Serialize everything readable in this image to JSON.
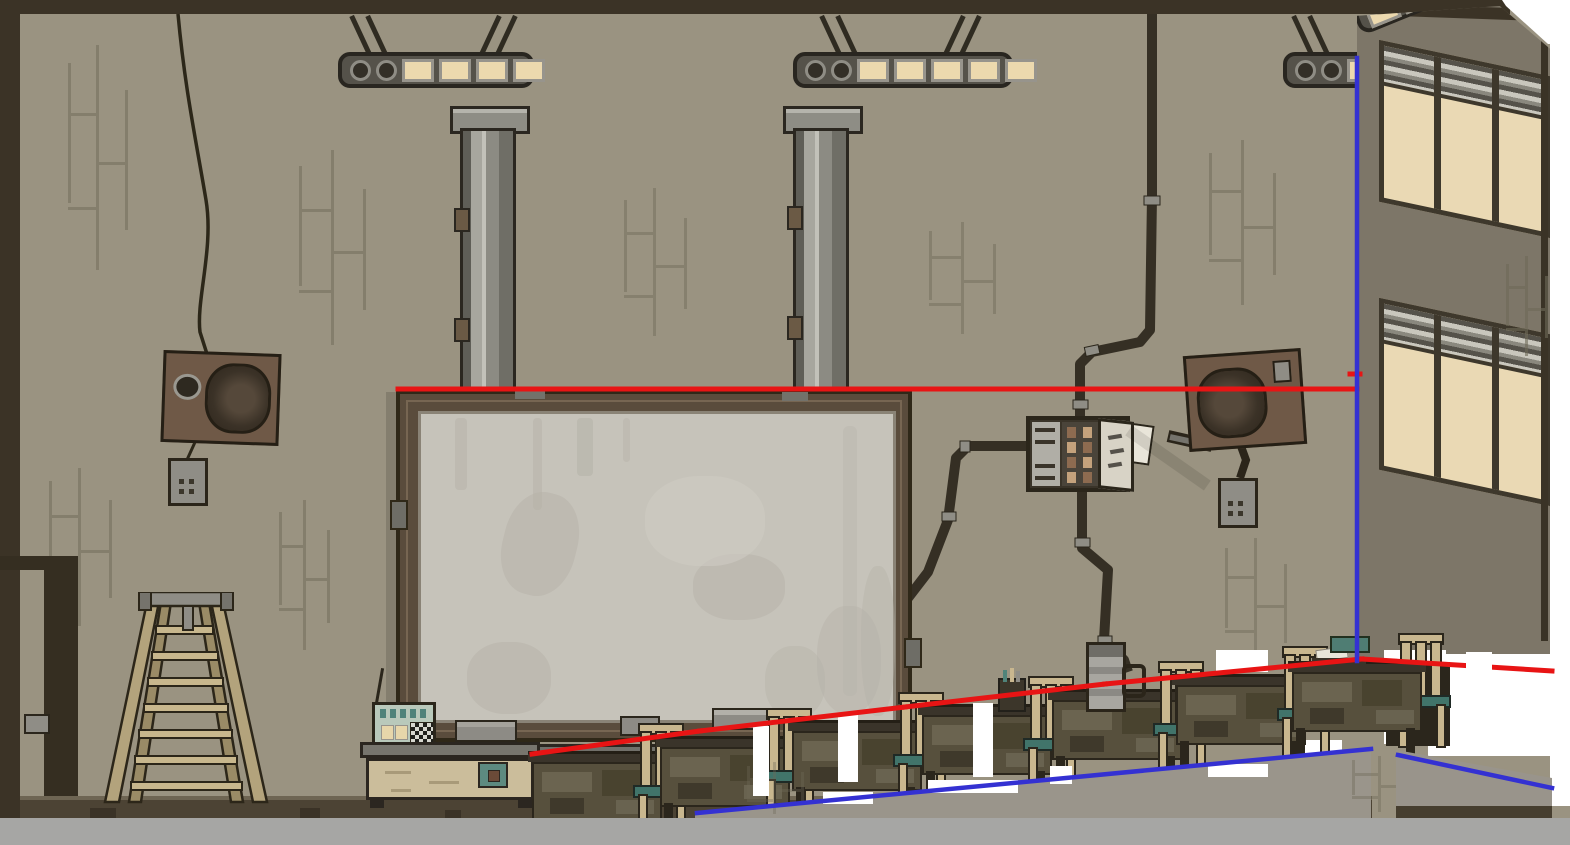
{
  "app": {
    "type": "game-screenshot",
    "description": "Pixel-art side-scrolling classroom interior with overlay annotation lines and white cutout regions",
    "visible_text": "none"
  },
  "palette": {
    "wall": "#9a9381",
    "wall_right": "#7d7668",
    "trim_dark": "#3b3326",
    "board_frame": "#5b4c3b",
    "board_surface": "#c6c3ba",
    "duct_metal": "#8c8b83",
    "light_cream": "#ecd9ae",
    "desk_body": "#57503d",
    "desk_top": "#3a342a",
    "chair_wood": "#c9b78f",
    "chair_seat": "#41746a",
    "cabinet_beige": "#cbbd9b",
    "metal_gray": "#8f8d86",
    "speaker_brown": "#6d5845",
    "floor_dark": "#4c4334",
    "floor_gray": "#a6a6a4",
    "parapet": "#9a958b",
    "window_pane": "#ead9b4",
    "annotation_red": "#e81414",
    "annotation_blue": "#3431d2",
    "cutout_white": "#ffffff"
  },
  "scene": {
    "objects": [
      "ceiling-light-rail x3",
      "ventilation-duct x2",
      "hanging-cable",
      "wall-speaker x2",
      "dangling-plug x2",
      "whiteboard",
      "fuse-box",
      "conduit-pipes",
      "step-ladder",
      "storage-cabinet",
      "radio",
      "side-counter",
      "student-desk x7",
      "chair x7",
      "thermos",
      "pencil-cup",
      "notebook-and-case",
      "window x2",
      "door-edge",
      "annotation-lines",
      "white-cutouts"
    ],
    "wall_marks": [
      {
        "layer": "wall-marks",
        "x": 55,
        "y": 45,
        "w": 85,
        "h": 225,
        "o": 0.5
      },
      {
        "layer": "wall-marks",
        "x": 285,
        "y": 150,
        "w": 95,
        "h": 195,
        "o": 0.5
      },
      {
        "layer": "wall-marks",
        "x": 610,
        "y": 188,
        "w": 90,
        "h": 148,
        "o": 0.45
      },
      {
        "layer": "wall-marks",
        "x": 915,
        "y": 222,
        "w": 95,
        "h": 112,
        "o": 0.45
      },
      {
        "layer": "wall-marks",
        "x": 1195,
        "y": 140,
        "w": 95,
        "h": 165,
        "o": 0.5
      },
      {
        "layer": "wall-marks",
        "x": 35,
        "y": 468,
        "w": 90,
        "h": 158,
        "o": 0.5
      },
      {
        "layer": "wall-marks",
        "x": 268,
        "y": 500,
        "w": 72,
        "h": 150,
        "o": 0.5
      },
      {
        "layer": "wall-marks",
        "x": 1212,
        "y": 538,
        "w": 88,
        "h": 128,
        "o": 0.45
      },
      {
        "layer": "rwall-marks",
        "x": 140,
        "y": 250,
        "w": 58,
        "h": 100,
        "o": 0.6
      },
      {
        "layer": "parapet-marks",
        "x": 735,
        "y": 762,
        "w": 80,
        "h": 52,
        "o": 0.35
      },
      {
        "layer": "parapet-marks",
        "x": 1340,
        "y": 756,
        "w": 80,
        "h": 56,
        "o": 0.4
      }
    ],
    "desks": [
      {
        "x": 528,
        "y": 751
      },
      {
        "x": 656,
        "y": 736
      },
      {
        "x": 788,
        "y": 720
      },
      {
        "x": 918,
        "y": 704
      },
      {
        "x": 1048,
        "y": 689
      },
      {
        "x": 1172,
        "y": 674
      },
      {
        "x": 1288,
        "y": 661,
        "backdrop": true
      }
    ],
    "white_bg": [
      [
        1384,
        650,
        62,
        94
      ],
      [
        1428,
        654,
        142,
        102
      ],
      [
        1290,
        740,
        52,
        14
      ],
      [
        1550,
        40,
        20,
        766
      ]
    ],
    "white_fg": [
      [
        753,
        726,
        16,
        70
      ],
      [
        838,
        714,
        20,
        68
      ],
      [
        973,
        703,
        20,
        74
      ],
      [
        1050,
        766,
        22,
        18
      ],
      [
        823,
        792,
        50,
        12
      ],
      [
        928,
        780,
        90,
        13
      ],
      [
        1216,
        650,
        52,
        22
      ],
      [
        1208,
        764,
        60,
        13
      ]
    ],
    "lines": {
      "red": {
        "color": "#e81414",
        "width": 5,
        "segs": [
          [
            398,
            389,
            1357,
            389
          ],
          [
            532,
            754,
            700,
            731
          ],
          [
            700,
            731,
            905,
            707
          ],
          [
            905,
            707,
            1105,
            684
          ],
          [
            1105,
            684,
            1362,
            659
          ],
          [
            1362,
            659,
            1552,
            671
          ],
          [
            1350,
            374,
            1360,
            374
          ]
        ]
      },
      "blue": {
        "color": "#3431d2",
        "width": 4.5,
        "segs": [
          [
            1357,
            58,
            1357,
            661
          ],
          [
            697,
            813,
            1371,
            749
          ],
          [
            1398,
            755,
            1552,
            788
          ]
        ]
      }
    },
    "notch": [
      1466,
      652,
      26,
      24
    ]
  }
}
